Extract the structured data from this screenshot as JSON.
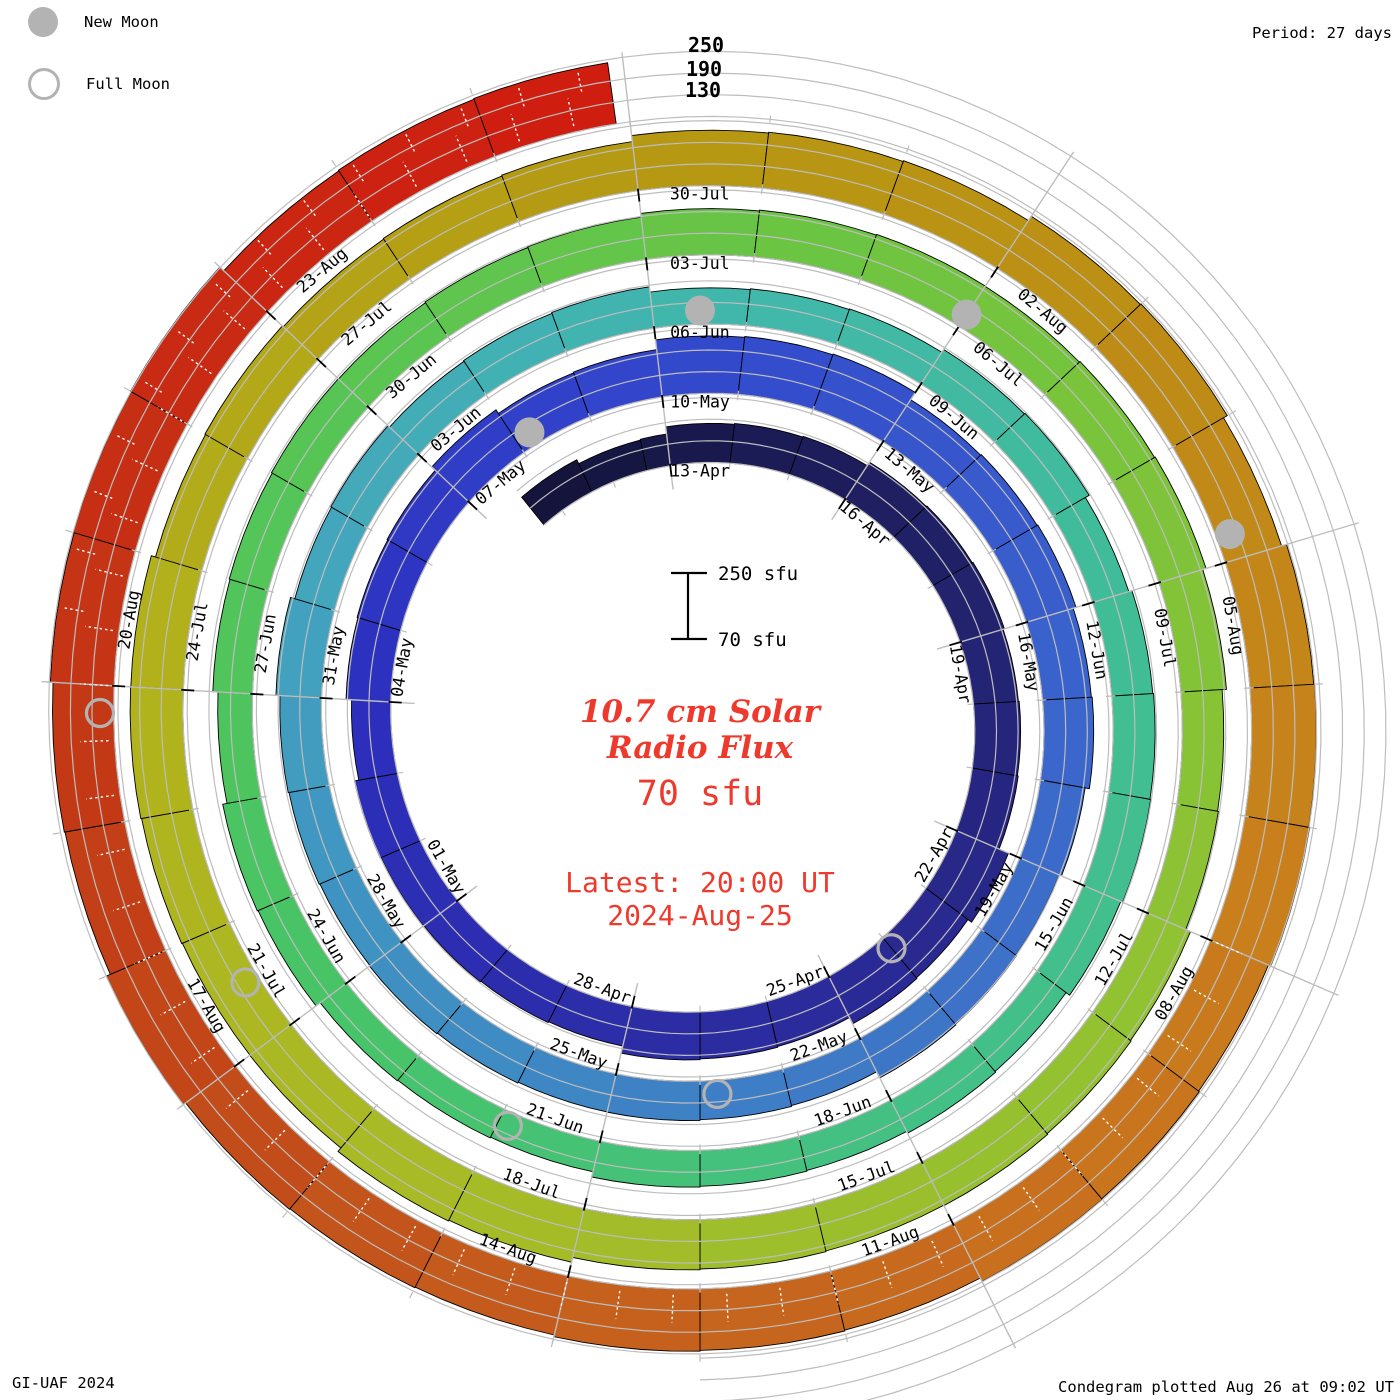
{
  "legend": {
    "new_moon": "New Moon",
    "full_moon": "Full Moon"
  },
  "header": {
    "period": "Period: 27 days"
  },
  "footer": {
    "credit": "GI-UAF 2024",
    "plotted": "Condegram plotted Aug 26 at 09:02 UT"
  },
  "center_text": {
    "title_line1": "10.7 cm Solar",
    "title_line2": "Radio Flux",
    "current_value": "70 sfu",
    "latest_time": "Latest: 20:00 UT",
    "latest_date": "2024-Aug-25"
  },
  "scale_bar": {
    "top": "250 sfu",
    "bottom": "70 sfu"
  },
  "radial_axis": {
    "ticks": [
      "250",
      "190",
      "130"
    ]
  },
  "colors": {
    "accent_red": "#ee3a2c",
    "moon_gray": "#b3b3b3",
    "grid_gray": "#bdbdbd",
    "label_black": "#000000",
    "background": "#ffffff"
  },
  "chart_data": {
    "type": "spiral_bar_condegram",
    "title": "10.7 cm Solar Radio Flux",
    "units": "sfu",
    "period_days": 27,
    "flux_axis": {
      "min": 70,
      "max": 250,
      "gridlines": [
        70,
        130,
        190,
        250
      ]
    },
    "start": "2024-Apr-10",
    "end": "2024-Aug-25 20:00 UT",
    "lead_in_flux": 175,
    "segments": [
      {
        "date": "13-Apr",
        "flux": 185
      },
      {
        "date": "16-Apr",
        "flux": 192
      },
      {
        "date": "19-Apr",
        "flux": 198
      },
      {
        "date": "22-Apr",
        "flux": 222
      },
      {
        "date": "25-Apr",
        "flux": 198
      },
      {
        "date": "28-Apr",
        "flux": 188
      },
      {
        "date": "01-May",
        "flux": 185
      },
      {
        "date": "04-May",
        "flux": 196
      },
      {
        "date": "07-May",
        "flux": 205
      },
      {
        "date": "10-May",
        "flux": 228
      },
      {
        "date": "13-May",
        "flux": 214
      },
      {
        "date": "16-May",
        "flux": 201
      },
      {
        "date": "19-May",
        "flux": 190
      },
      {
        "date": "22-May",
        "flux": 181
      },
      {
        "date": "25-May",
        "flux": 176
      },
      {
        "date": "28-May",
        "flux": 184
      },
      {
        "date": "31-May",
        "flux": 191
      },
      {
        "date": "03-Jun",
        "flux": 181
      },
      {
        "date": "06-Jun",
        "flux": 176
      },
      {
        "date": "09-Jun",
        "flux": 181
      },
      {
        "date": "12-Jun",
        "flux": 186
      },
      {
        "date": "15-Jun",
        "flux": 176
      },
      {
        "date": "18-Jun",
        "flux": 166
      },
      {
        "date": "21-Jun",
        "flux": 161
      },
      {
        "date": "24-Jun",
        "flux": 171
      },
      {
        "date": "27-Jun",
        "flux": 181
      },
      {
        "date": "30-Jun",
        "flux": 190
      },
      {
        "date": "03-Jul",
        "flux": 196
      },
      {
        "date": "06-Jul",
        "flux": 205
      },
      {
        "date": "09-Jul",
        "flux": 191
      },
      {
        "date": "12-Jul",
        "flux": 201
      },
      {
        "date": "15-Jul",
        "flux": 210
      },
      {
        "date": "18-Jul",
        "flux": 219
      },
      {
        "date": "21-Jul",
        "flux": 214
      },
      {
        "date": "24-Jul",
        "flux": 209
      },
      {
        "date": "27-Jul",
        "flux": 201
      },
      {
        "date": "30-Jul",
        "flux": 228
      },
      {
        "date": "02-Aug",
        "flux": 238
      },
      {
        "date": "05-Aug",
        "flux": 248
      },
      {
        "date": "08-Aug",
        "flux": 251
      },
      {
        "date": "11-Aug",
        "flux": 236
      },
      {
        "date": "14-Aug",
        "flux": 241
      },
      {
        "date": "17-Aug",
        "flux": 244
      },
      {
        "date": "20-Aug",
        "flux": 247
      },
      {
        "date": "23-Aug",
        "flux": 242
      }
    ],
    "new_moons": [
      {
        "date": "08-May",
        "day": 24.7
      },
      {
        "date": "06-Jun",
        "day": 54.0
      },
      {
        "date": "05-Jul",
        "day": 83.5
      },
      {
        "date": "04-Aug",
        "day": 113.3
      }
    ],
    "full_moons": [
      {
        "date": "23-Apr",
        "day": 10.5
      },
      {
        "date": "23-May",
        "day": 40.3
      },
      {
        "date": "21-Jun",
        "day": 69.4
      },
      {
        "date": "21-Jul",
        "day": 99.0
      },
      {
        "date": "19-Aug",
        "day": 128.3
      }
    ],
    "color_stops": [
      [
        -3,
        "#131339"
      ],
      [
        6,
        "#232370"
      ],
      [
        12,
        "#2b2b9a"
      ],
      [
        21,
        "#2d2fbe"
      ],
      [
        27,
        "#3247cc"
      ],
      [
        33,
        "#3a60cc"
      ],
      [
        40,
        "#3e7cc6"
      ],
      [
        46,
        "#3f95c2"
      ],
      [
        50,
        "#44a8bc"
      ],
      [
        54,
        "#41b6ae"
      ],
      [
        60,
        "#41bd98"
      ],
      [
        66,
        "#43c084"
      ],
      [
        72,
        "#47c468"
      ],
      [
        78,
        "#58c553"
      ],
      [
        84,
        "#73c43e"
      ],
      [
        90,
        "#8ec232"
      ],
      [
        96,
        "#a4bd28"
      ],
      [
        102,
        "#b2b21c"
      ],
      [
        108,
        "#b59912"
      ],
      [
        112,
        "#bd8d15"
      ],
      [
        116,
        "#c8811c"
      ],
      [
        120,
        "#c86d1e"
      ],
      [
        124,
        "#c3581c"
      ],
      [
        128,
        "#c23b16"
      ],
      [
        132,
        "#c92812"
      ],
      [
        135,
        "#d01c10"
      ]
    ]
  }
}
